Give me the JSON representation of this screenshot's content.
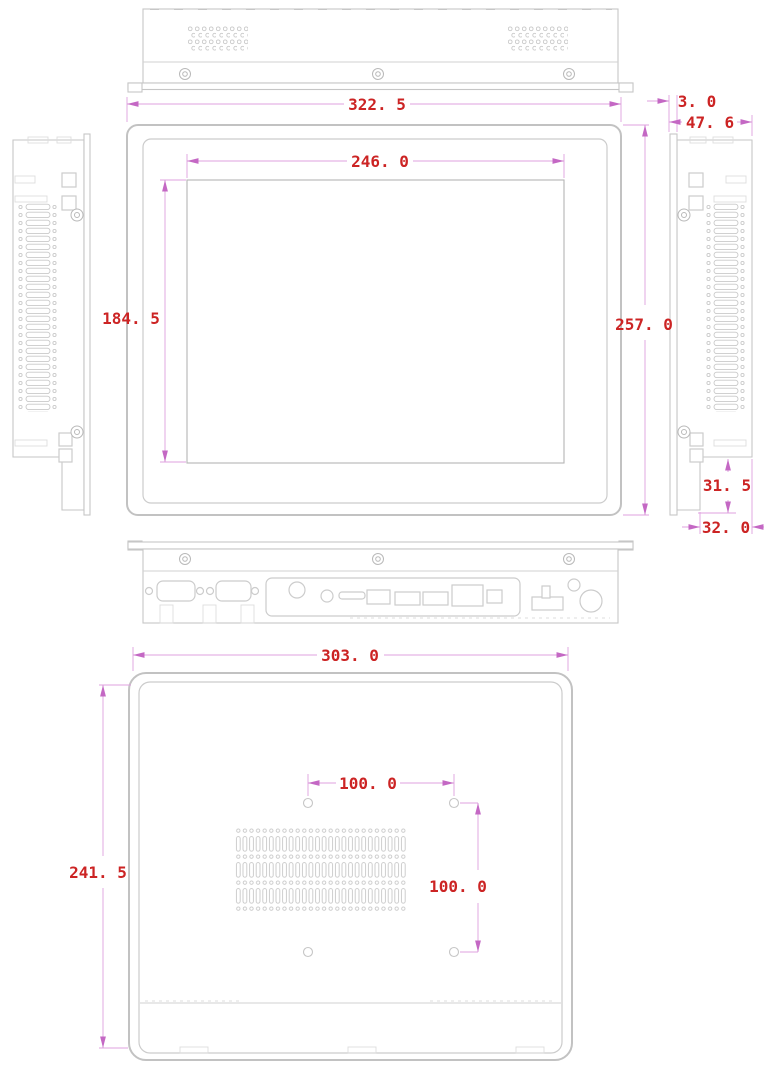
{
  "drawing": {
    "type": "mechanical-dimension-drawing",
    "subject": "panel-pc-enclosure",
    "colors": {
      "dimension_text": "#cc2424",
      "dimension_line": "#dfa0df",
      "outline": "#c6c6c6",
      "background": "#ffffff"
    }
  },
  "dimensions": {
    "front_width": "322. 5",
    "display_width": "246. 0",
    "display_height": "184. 5",
    "front_height": "257. 0",
    "bezel_thickness": "3. 0",
    "depth": "47. 6",
    "io_step_height": "31. 5",
    "io_step_width": "32. 0",
    "rear_width": "303. 0",
    "rear_height": "241. 5",
    "vesa_width": "100. 0",
    "vesa_height": "100. 0"
  }
}
